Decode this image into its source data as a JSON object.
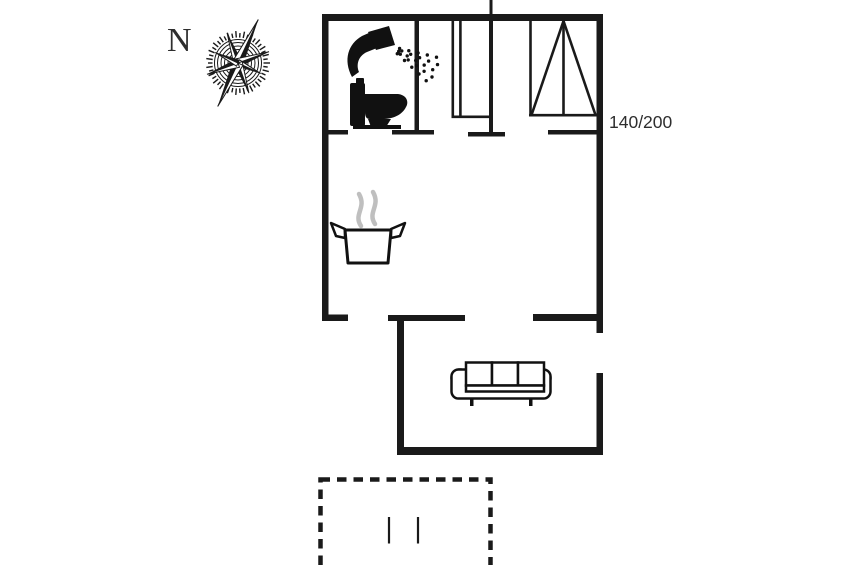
{
  "compass": {
    "north_label": "N"
  },
  "labels": {
    "bed_size": "140/200"
  },
  "colors": {
    "wall": "#1a1a1a",
    "background": "#ffffff",
    "steam": "#bfbfbf",
    "label": "#2e2e2e"
  },
  "icons": {
    "compass": "compass-rose",
    "shower": "shower-head-spray",
    "toilet": "toilet-side-view",
    "stove": "cooking-pot-with-steam",
    "sofa": "three-seat-sofa",
    "bed": "bed-140x200-symbol",
    "wardrobe": "wardrobe-double-line-symbol",
    "terrace": "dashed-terrace-outline"
  }
}
